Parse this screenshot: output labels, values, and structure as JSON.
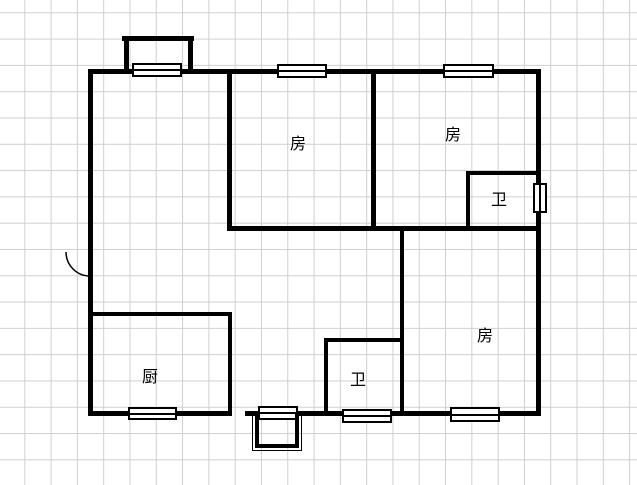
{
  "canvas": {
    "width": 637,
    "height": 485,
    "background": "#ffffff",
    "grid": {
      "spacing": 26.3,
      "color": "#cfcfcf",
      "offset_x": 24.3,
      "offset_y": 12.3
    }
  },
  "floorplan": {
    "wall_color": "#000000",
    "window_fill": "#ffffff",
    "window_border": "#000000",
    "walls": [
      {
        "name": "outer-wall-top",
        "x": 88,
        "y": 69,
        "w": 453,
        "h": 5
      },
      {
        "name": "outer-wall-left",
        "x": 88,
        "y": 69,
        "w": 5,
        "h": 347
      },
      {
        "name": "outer-wall-right",
        "x": 536,
        "y": 69,
        "w": 5,
        "h": 347
      },
      {
        "name": "outer-wall-bottom-left",
        "x": 88,
        "y": 411,
        "w": 143,
        "h": 5
      },
      {
        "name": "outer-wall-bottom-right",
        "x": 245,
        "y": 411,
        "w": 296,
        "h": 5
      },
      {
        "name": "interior-wall-mid-horizontal",
        "x": 227,
        "y": 226,
        "w": 314,
        "h": 5
      },
      {
        "name": "bedroom1-wall-left",
        "x": 227,
        "y": 69,
        "w": 5,
        "h": 162
      },
      {
        "name": "bedroom-divider-wall",
        "x": 371,
        "y": 69,
        "w": 5,
        "h": 162
      },
      {
        "name": "bedroom3-wall-left",
        "x": 400,
        "y": 226,
        "w": 4,
        "h": 190
      },
      {
        "name": "bath1-wall-left",
        "x": 466,
        "y": 171,
        "w": 4,
        "h": 60
      },
      {
        "name": "bath1-wall-top",
        "x": 466,
        "y": 171,
        "w": 75,
        "h": 4
      },
      {
        "name": "kitchen-wall-top",
        "x": 88,
        "y": 312,
        "w": 144,
        "h": 4
      },
      {
        "name": "kitchen-wall-right",
        "x": 228,
        "y": 312,
        "w": 4,
        "h": 104
      },
      {
        "name": "bath2-wall-left",
        "x": 324,
        "y": 338,
        "w": 4,
        "h": 78
      },
      {
        "name": "bath2-wall-top",
        "x": 324,
        "y": 338,
        "w": 80,
        "h": 4
      },
      {
        "name": "balcony-wall-left",
        "x": 124,
        "y": 36,
        "w": 5,
        "h": 33
      },
      {
        "name": "balcony-wall-right",
        "x": 188,
        "y": 36,
        "w": 5,
        "h": 33
      },
      {
        "name": "balcony-wall-top",
        "x": 122,
        "y": 36,
        "w": 72,
        "h": 5
      }
    ],
    "windows": [
      {
        "name": "window-balcony",
        "x": 132,
        "y": 63,
        "w": 50,
        "h": 14,
        "orient": "h"
      },
      {
        "name": "window-top-bedroom1",
        "x": 277,
        "y": 64,
        "w": 50,
        "h": 14,
        "orient": "h"
      },
      {
        "name": "window-top-bedroom2",
        "x": 443,
        "y": 64,
        "w": 51,
        "h": 14,
        "orient": "h"
      },
      {
        "name": "window-right-bath1",
        "x": 533,
        "y": 183,
        "w": 14,
        "h": 30,
        "orient": "v"
      },
      {
        "name": "window-kitchen",
        "x": 128,
        "y": 407,
        "w": 49,
        "h": 13,
        "orient": "h"
      },
      {
        "name": "window-porch",
        "x": 258,
        "y": 406,
        "w": 40,
        "h": 14,
        "orient": "h"
      },
      {
        "name": "window-bath2",
        "x": 342,
        "y": 409,
        "w": 50,
        "h": 14,
        "orient": "h"
      },
      {
        "name": "window-bedroom3",
        "x": 450,
        "y": 407,
        "w": 50,
        "h": 15,
        "orient": "h"
      }
    ],
    "porch": {
      "name": "entry-porch",
      "x": 252,
      "y": 414,
      "w": 50,
      "h": 37
    },
    "door_arc": {
      "name": "entry-door-swing",
      "left": 64,
      "top": 250,
      "width": 28,
      "height": 28,
      "path": "M 2 2 A 24 24 0 0 0 26 26",
      "color": "#000000"
    },
    "labels": [
      {
        "name": "room-label-bedroom-1",
        "text": "房",
        "x": 298,
        "y": 144
      },
      {
        "name": "room-label-bedroom-2",
        "text": "房",
        "x": 453,
        "y": 135
      },
      {
        "name": "room-label-bedroom-3",
        "text": "房",
        "x": 485,
        "y": 336
      },
      {
        "name": "room-label-bath-1",
        "text": "卫",
        "x": 499,
        "y": 200
      },
      {
        "name": "room-label-bath-2",
        "text": "卫",
        "x": 358,
        "y": 380
      },
      {
        "name": "room-label-kitchen",
        "text": "厨",
        "x": 150,
        "y": 377
      }
    ]
  }
}
